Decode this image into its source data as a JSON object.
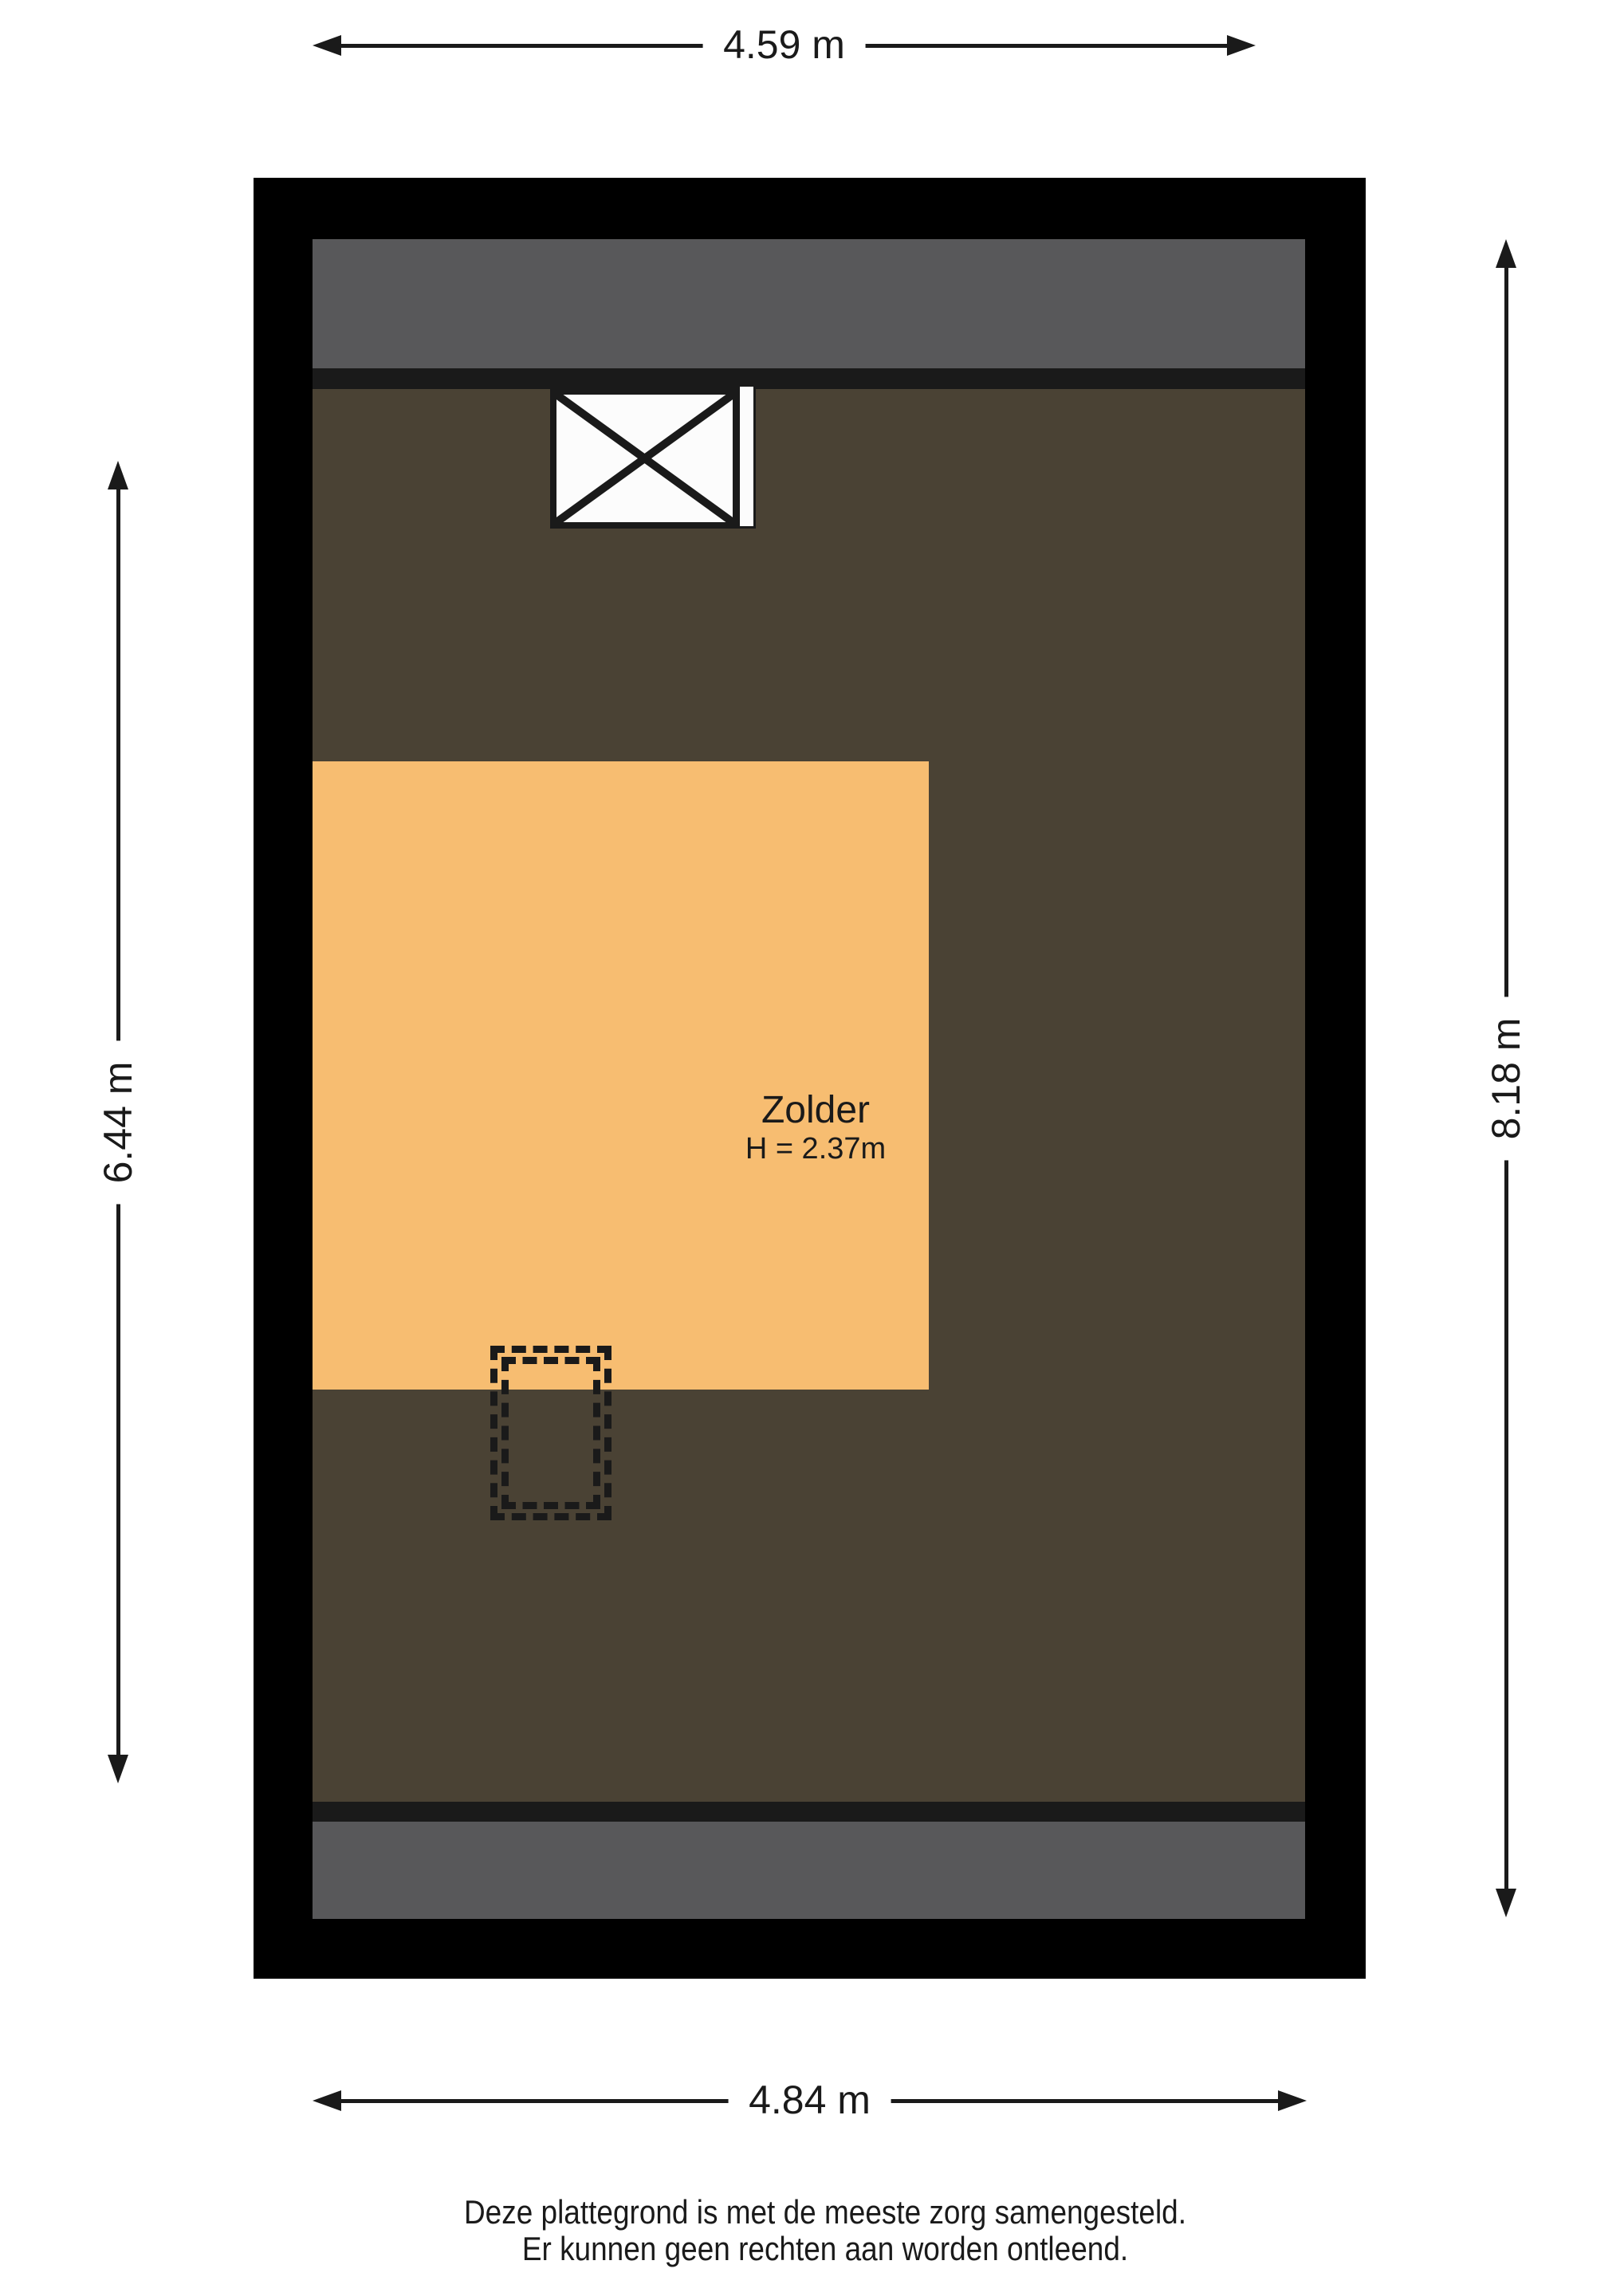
{
  "colors": {
    "page-bg": "#ffffff",
    "wall": "#000000",
    "roof": "#58585a",
    "strip": "#1a1a1a",
    "floor": "#4a4234",
    "room": "#f7bd71",
    "line": "#1a1a1a",
    "symbol-fill": "#fcfcfc"
  },
  "dimensions": {
    "top": "4.59 m",
    "bottom": "4.84 m",
    "left": "6.44 m",
    "right": "8.18 m"
  },
  "room": {
    "name": "Zolder",
    "height": "H = 2.37m"
  },
  "footer": {
    "line1": "Deze plattegrond is met de meeste zorg samengesteld.",
    "line2": "Er kunnen geen rechten aan worden ontleend."
  }
}
